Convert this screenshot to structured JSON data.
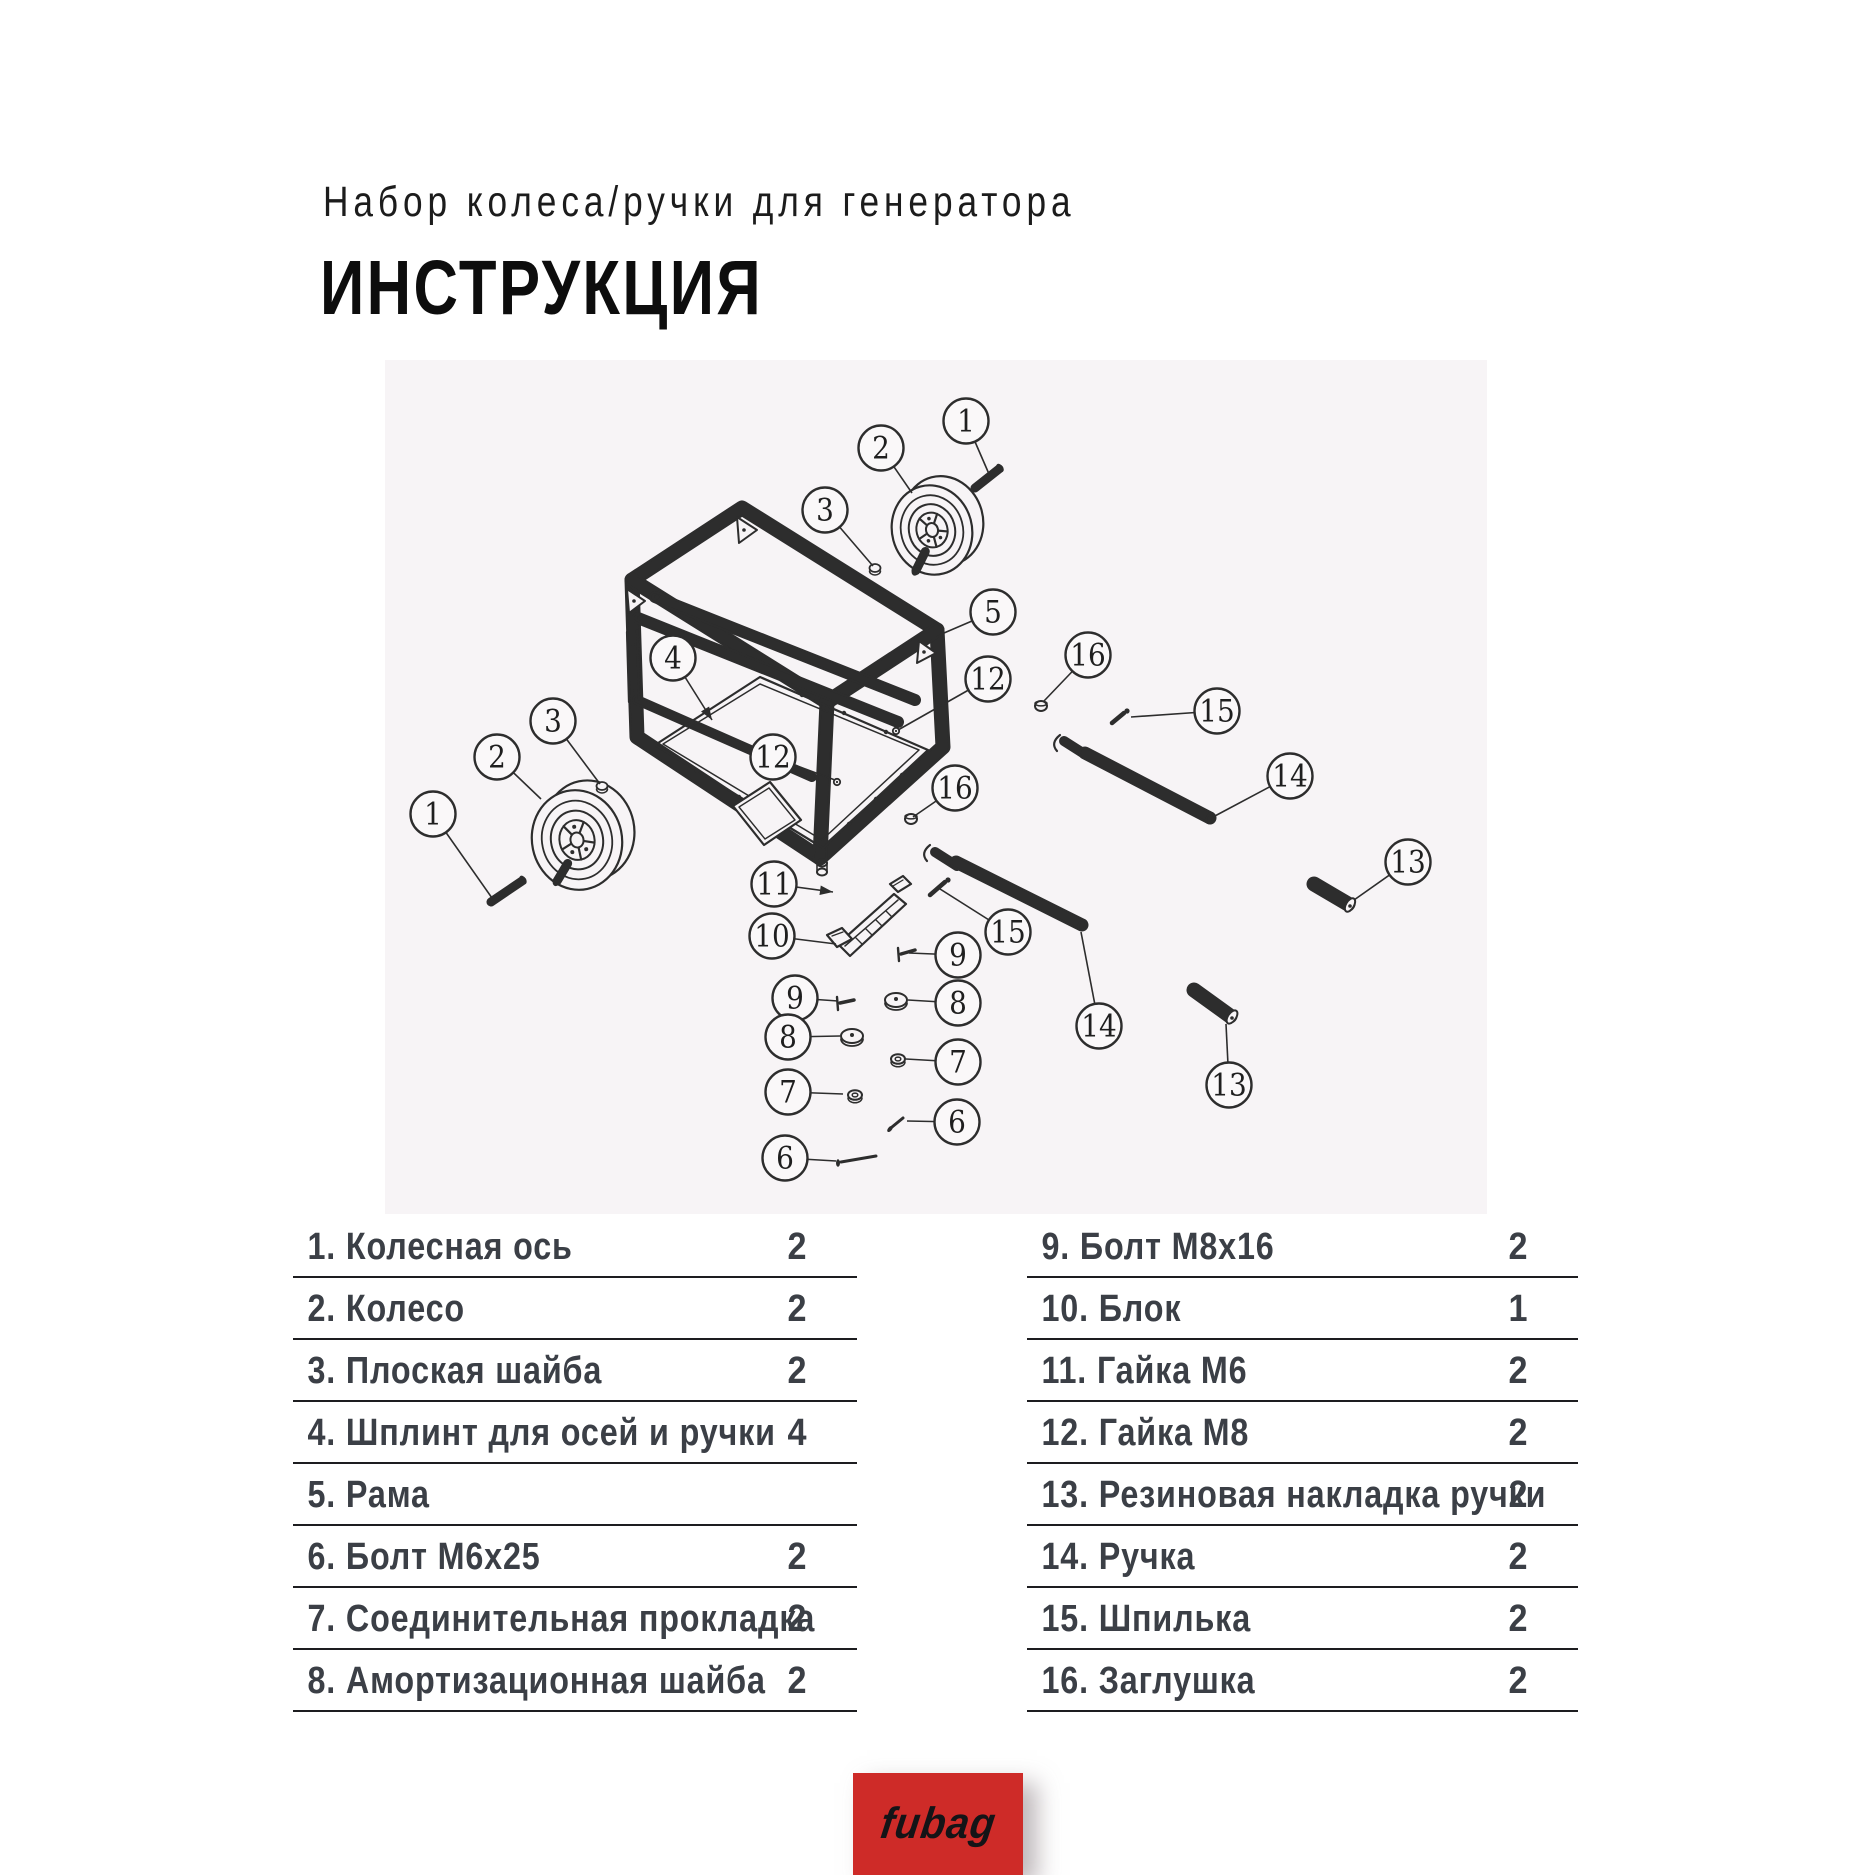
{
  "header": {
    "subtitle": "Набор колеса/ручки для генератора",
    "title": "ИНСТРУКЦИЯ"
  },
  "colors": {
    "page_bg": "#ffffff",
    "diagram_bg": "#f7f4f6",
    "diagram_line": "#2d2d2d",
    "table_text": "#3b3f46",
    "table_line": "#1d1d20",
    "title_text": "#0d0d0d",
    "logo_bg": "#ce2b28",
    "logo_text": "#141417"
  },
  "parts_table": {
    "left": [
      {
        "num": "1.",
        "name": "Колесная ось",
        "qty": "2"
      },
      {
        "num": "2.",
        "name": "Колесо",
        "qty": "2"
      },
      {
        "num": "3.",
        "name": "Плоская шайба",
        "qty": "2"
      },
      {
        "num": "4.",
        "name": "Шплинт для осей и ручки",
        "qty": "4"
      },
      {
        "num": "5.",
        "name": "Рама",
        "qty": ""
      },
      {
        "num": "6.",
        "name": "Болт М6х25",
        "qty": "2"
      },
      {
        "num": "7.",
        "name": "Соединительная прокладка",
        "qty": "2"
      },
      {
        "num": "8.",
        "name": "Амортизационная шайба",
        "qty": "2"
      }
    ],
    "right": [
      {
        "num": "9.",
        "name": "Болт М8х16",
        "qty": "2"
      },
      {
        "num": "10.",
        "name": "Блок",
        "qty": "1"
      },
      {
        "num": "11.",
        "name": "Гайка М6",
        "qty": "2"
      },
      {
        "num": "12.",
        "name": "Гайка М8",
        "qty": "2"
      },
      {
        "num": "13.",
        "name": "Резиновая накладка ручки",
        "qty": "2"
      },
      {
        "num": "14.",
        "name": "Ручка",
        "qty": "2"
      },
      {
        "num": "15.",
        "name": "Шпилька",
        "qty": "2"
      },
      {
        "num": "16.",
        "name": "Заглушка",
        "qty": "2"
      }
    ]
  },
  "diagram": {
    "callouts": [
      {
        "n": "1",
        "x": 966,
        "y": 421,
        "ex": 989,
        "ey": 474,
        "arrow": false
      },
      {
        "n": "2",
        "x": 881,
        "y": 448,
        "ex": 912,
        "ey": 493,
        "arrow": false
      },
      {
        "n": "3",
        "x": 825,
        "y": 510,
        "ex": 873,
        "ey": 566,
        "arrow": false
      },
      {
        "n": "5",
        "x": 993,
        "y": 612,
        "ex": 944,
        "ey": 633,
        "arrow": false
      },
      {
        "n": "12",
        "x": 988,
        "y": 679,
        "ex": 898,
        "ey": 730,
        "arrow": false
      },
      {
        "n": "16",
        "x": 1088,
        "y": 655,
        "ex": 1044,
        "ey": 701,
        "arrow": false
      },
      {
        "n": "15",
        "x": 1217,
        "y": 711,
        "ex": 1131,
        "ey": 717,
        "arrow": false
      },
      {
        "n": "14",
        "x": 1290,
        "y": 776,
        "ex": 1213,
        "ey": 817,
        "arrow": false
      },
      {
        "n": "13",
        "x": 1408,
        "y": 862,
        "ex": 1354,
        "ey": 900,
        "arrow": false
      },
      {
        "n": "3",
        "x": 553,
        "y": 721,
        "ex": 600,
        "ey": 784,
        "arrow": false
      },
      {
        "n": "2",
        "x": 497,
        "y": 757,
        "ex": 541,
        "ey": 799,
        "arrow": false
      },
      {
        "n": "1",
        "x": 433,
        "y": 814,
        "ex": 492,
        "ey": 898,
        "arrow": false
      },
      {
        "n": "4",
        "x": 673,
        "y": 658,
        "ex": 712,
        "ey": 720,
        "arrow": true
      },
      {
        "n": "12",
        "x": 773,
        "y": 757,
        "ex": 835,
        "ey": 780,
        "arrow": false
      },
      {
        "n": "16",
        "x": 955,
        "y": 788,
        "ex": 913,
        "ey": 817,
        "arrow": false
      },
      {
        "n": "11",
        "x": 774,
        "y": 884,
        "ex": 833,
        "ey": 892,
        "arrow": true
      },
      {
        "n": "10",
        "x": 772,
        "y": 936,
        "ex": 836,
        "ey": 944,
        "arrow": false
      },
      {
        "n": "15",
        "x": 1008,
        "y": 932,
        "ex": 940,
        "ey": 889,
        "arrow": false
      },
      {
        "n": "9",
        "x": 958,
        "y": 955,
        "ex": 909,
        "ey": 953,
        "arrow": false
      },
      {
        "n": "8",
        "x": 958,
        "y": 1003,
        "ex": 908,
        "ey": 1000,
        "arrow": false
      },
      {
        "n": "7",
        "x": 958,
        "y": 1062,
        "ex": 906,
        "ey": 1059,
        "arrow": false
      },
      {
        "n": "6",
        "x": 957,
        "y": 1122,
        "ex": 907,
        "ey": 1121,
        "arrow": false
      },
      {
        "n": "9",
        "x": 795,
        "y": 998,
        "ex": 838,
        "ey": 1001,
        "arrow": false
      },
      {
        "n": "8",
        "x": 788,
        "y": 1037,
        "ex": 840,
        "ey": 1036,
        "arrow": false
      },
      {
        "n": "7",
        "x": 788,
        "y": 1092,
        "ex": 843,
        "ey": 1094,
        "arrow": false
      },
      {
        "n": "6",
        "x": 785,
        "y": 1158,
        "ex": 836,
        "ey": 1161,
        "arrow": false
      },
      {
        "n": "14",
        "x": 1099,
        "y": 1026,
        "ex": 1081,
        "ey": 932,
        "arrow": false
      },
      {
        "n": "13",
        "x": 1229,
        "y": 1085,
        "ex": 1226,
        "ey": 1024,
        "arrow": false
      }
    ]
  },
  "logo": {
    "text": "fubag"
  }
}
